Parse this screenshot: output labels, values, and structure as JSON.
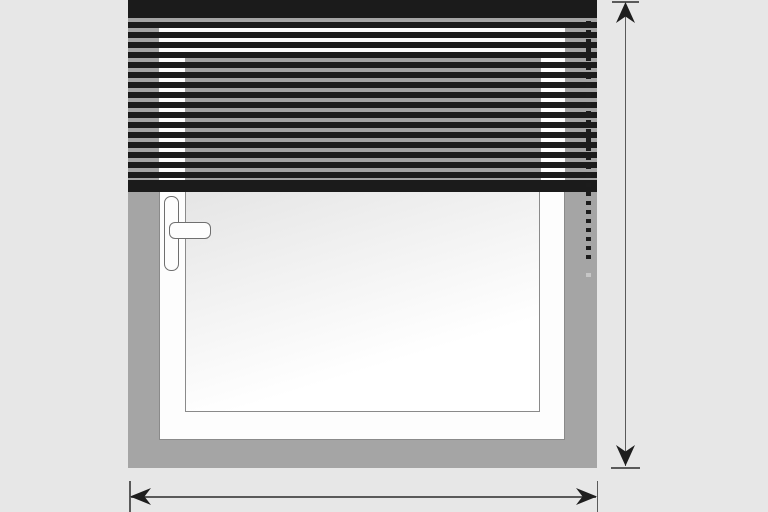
{
  "meta": {
    "kind": "technical-illustration",
    "subject": "Window with partially lowered venetian blind, control chain, and height/width dimension arrows",
    "visible_text": ""
  },
  "colors": {
    "background": "#e7e7e7",
    "wall": "#a5a5a5",
    "frame_white": "#fdfdfd",
    "outline": "#8a8a8a",
    "handle_outline": "#6f6f6f",
    "glass_dark": "#d6d6d6",
    "glass_light": "#ffffff",
    "slat": "#1b1b1b",
    "gap_glass": "#a2a2a2",
    "chain": "#1c1c1c",
    "chain_faint": "#c6c6c6",
    "dim_line": "#5a5a5a",
    "arrow": "#1e1e1e"
  },
  "scene": {
    "wall": {
      "description": "grey wall / recess surround around window"
    },
    "window": {
      "frame": "white frame with thin grey outline",
      "glass": "light diagonal-gradient glazing",
      "handle": "white lever handle on left stile, grip pointing right"
    },
    "blind": {
      "type": "venetian blind",
      "state": "lowered over upper portion of window",
      "headrail": "solid dark headrail at top",
      "bottomrail": "solid dark bottom rail",
      "slat_gap_count": 16,
      "slat_pitch_px": 10
    },
    "chain": {
      "description": "dotted control chain hanging on right side of blind"
    }
  },
  "dimensions": {
    "vertical": {
      "label": "",
      "arrow_glyphs": [
        "▲",
        "▼"
      ],
      "measures": "overall height of the recess (top edge to bottom of wall opening)",
      "position": "right of window"
    },
    "horizontal": {
      "label": "",
      "arrow_glyphs": [
        "◀",
        "▶"
      ],
      "measures": "overall width of the recess (left wall edge to right wall edge)",
      "position": "below window"
    }
  }
}
